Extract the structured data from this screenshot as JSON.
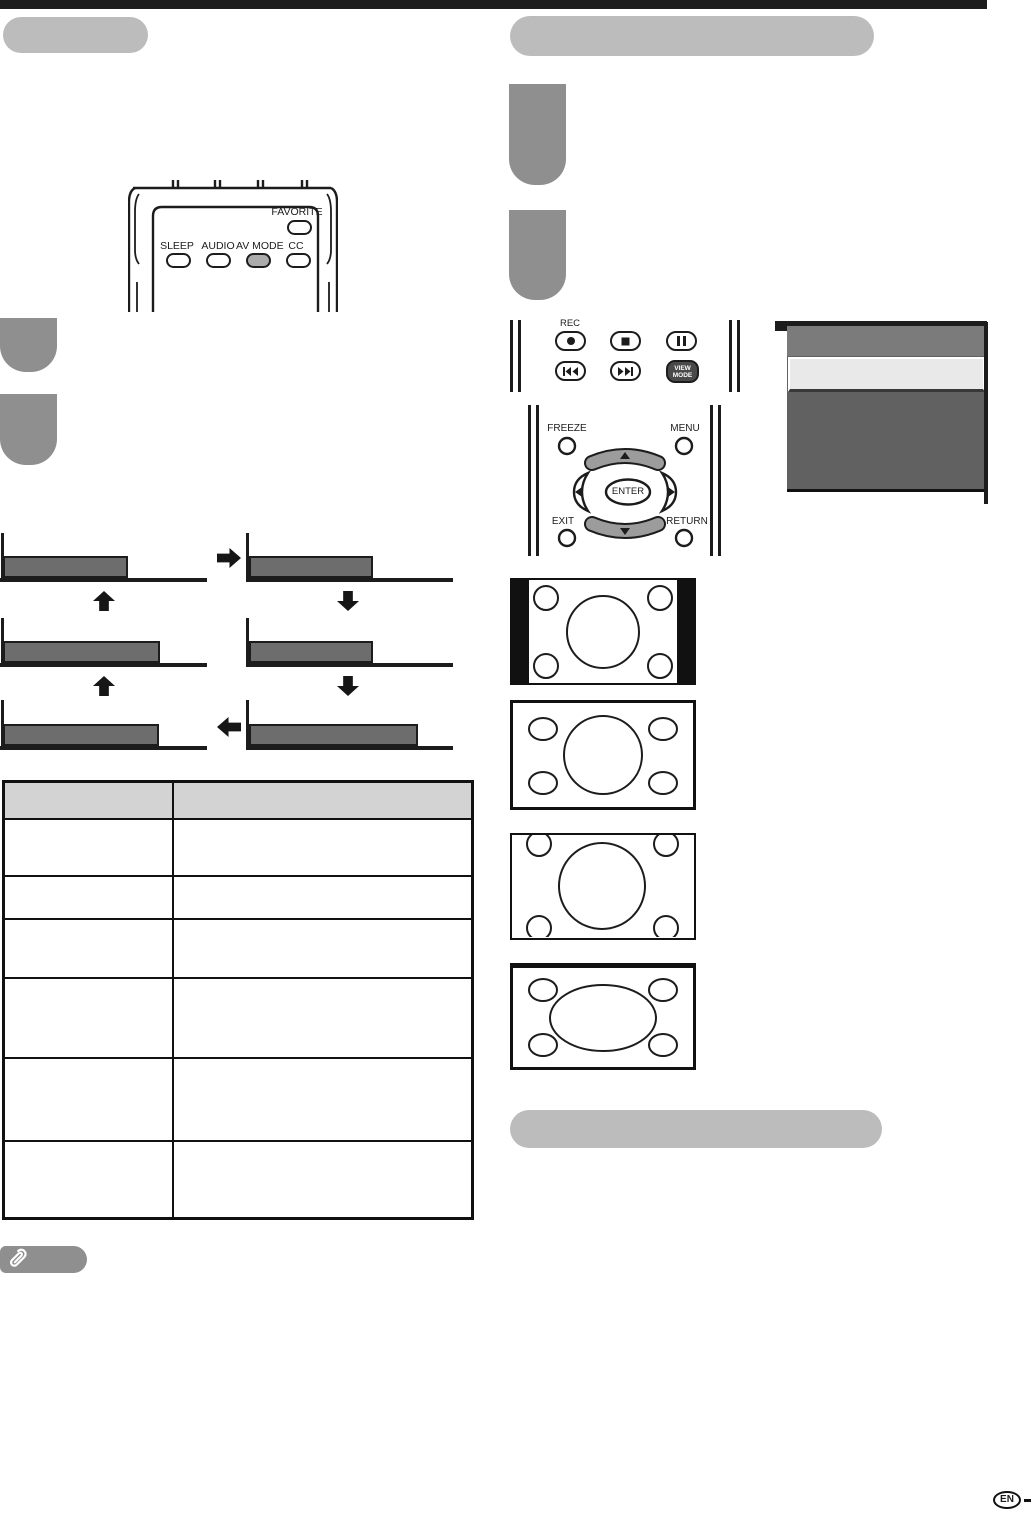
{
  "colors": {
    "ink": "#1c1c1c",
    "header_pill": "#bcbcbc",
    "step_block": "#8f8f8f",
    "flow_bar": "#6d6d6d",
    "table_header_bg": "#d3d3d3",
    "note_pill": "#8f8f8f",
    "menu_header": "#7b7b7b",
    "menu_body": "#616161",
    "menu_highlight": "#e9e9e9",
    "crescent_button": "#9c9c9c",
    "dark_button": "#4a4a4a",
    "highlighted_button": "#ababab"
  },
  "remote_top": {
    "favorite": "FAVORITE",
    "sleep": "SLEEP",
    "audio": "AUDIO",
    "av_mode": "AV MODE",
    "cc": "CC"
  },
  "remote_playback": {
    "rec": "REC",
    "view_mode_line1": "VIEW",
    "view_mode_line2": "MODE"
  },
  "remote_nav": {
    "freeze": "FREEZE",
    "menu": "MENU",
    "enter": "ENTER",
    "exit": "EXIT",
    "return": "RETURN"
  },
  "footer": {
    "language_badge": "EN"
  }
}
